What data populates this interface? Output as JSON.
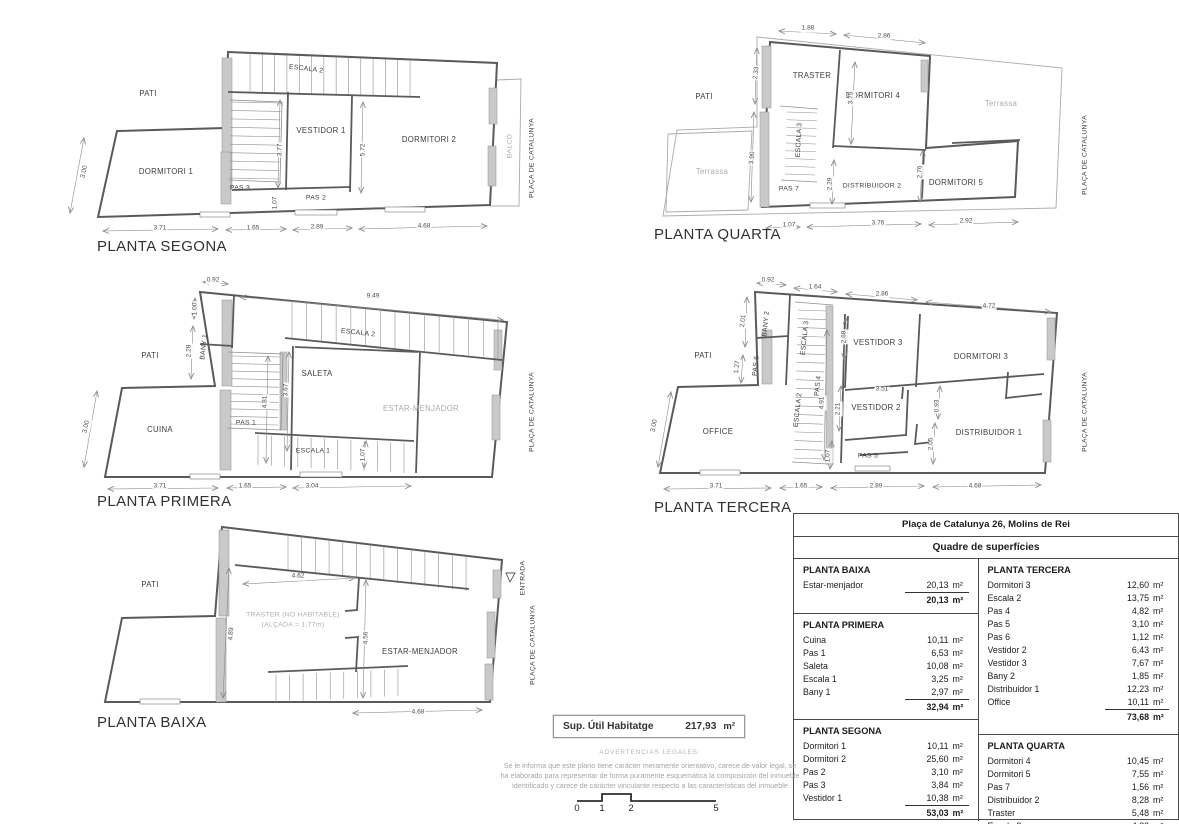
{
  "colors": {
    "wall_fill": "#c9c9c9",
    "line": "#5a5a5a",
    "thin": "#ababab",
    "dim": "#8a8a8a",
    "muted_text": "#adadad"
  },
  "plans": [
    {
      "id": "segona",
      "title": "PLANTA SEGONA",
      "labels": [
        {
          "t": "PATI",
          "x": 148,
          "y": 94
        },
        {
          "t": "ESCALA 2",
          "x": 306,
          "y": 70,
          "r": 7,
          "c": "sm"
        },
        {
          "t": "VESTIDOR 1",
          "x": 321,
          "y": 131
        },
        {
          "t": "DORMITORI 2",
          "x": 429,
          "y": 140
        },
        {
          "t": "DORMITORI 1",
          "x": 166,
          "y": 172
        },
        {
          "t": "PAS 3",
          "x": 240,
          "y": 189,
          "c": "sm"
        },
        {
          "t": "PAS 2",
          "x": 316,
          "y": 199,
          "c": "sm"
        },
        {
          "t": "BALCÓ",
          "x": 511,
          "y": 146,
          "r": -90,
          "c": "sm gy"
        },
        {
          "t": "PLAÇA DE CATALUNYA",
          "x": 533,
          "y": 158,
          "r": -90,
          "c": "sm"
        }
      ],
      "dims": [
        {
          "t": "3.00",
          "x": 85,
          "y": 172,
          "r": -78
        },
        {
          "t": "3.77",
          "x": 281,
          "y": 150,
          "r": -90
        },
        {
          "t": "5.72",
          "x": 364,
          "y": 150,
          "r": -90
        },
        {
          "t": "1.07",
          "x": 276,
          "y": 203,
          "r": -90
        },
        {
          "t": "3.71",
          "x": 160,
          "y": 229
        },
        {
          "t": "1.65",
          "x": 253,
          "y": 229
        },
        {
          "t": "2.89",
          "x": 317,
          "y": 228
        },
        {
          "t": "4.68",
          "x": 424,
          "y": 227
        }
      ]
    },
    {
      "id": "quarta",
      "title": "PLANTA QUARTA",
      "labels": [
        {
          "t": "PATI",
          "x": 704,
          "y": 97
        },
        {
          "t": "Terrassa",
          "x": 712,
          "y": 172,
          "c": "gy"
        },
        {
          "t": "TRASTER",
          "x": 812,
          "y": 76
        },
        {
          "t": "DORMITORI 4",
          "x": 873,
          "y": 96
        },
        {
          "t": "Terrassa",
          "x": 1001,
          "y": 104,
          "c": "gy"
        },
        {
          "t": "ESCALA 3",
          "x": 800,
          "y": 140,
          "r": -87,
          "c": "sm"
        },
        {
          "t": "PAS 7",
          "x": 789,
          "y": 190,
          "c": "sm"
        },
        {
          "t": "DISTRIBUIDOR 2",
          "x": 872,
          "y": 187,
          "c": "sm"
        },
        {
          "t": "DORMITORI 5",
          "x": 956,
          "y": 183
        },
        {
          "t": "PLAÇA DE CATALUNYA",
          "x": 1086,
          "y": 155,
          "r": -90,
          "c": "sm"
        }
      ],
      "dims": [
        {
          "t": "1.88",
          "x": 808,
          "y": 29
        },
        {
          "t": "2.86",
          "x": 884,
          "y": 37
        },
        {
          "t": "2.33",
          "x": 757,
          "y": 73,
          "r": -84
        },
        {
          "t": "3.90",
          "x": 753,
          "y": 158,
          "r": -84
        },
        {
          "t": "3.75",
          "x": 852,
          "y": 98,
          "r": -90
        },
        {
          "t": "2.29",
          "x": 831,
          "y": 184,
          "r": -90
        },
        {
          "t": "2.76",
          "x": 921,
          "y": 172,
          "r": -90
        },
        {
          "t": "1.07",
          "x": 789,
          "y": 226
        },
        {
          "t": "3.76",
          "x": 878,
          "y": 224
        },
        {
          "t": "2.92",
          "x": 966,
          "y": 222
        }
      ]
    },
    {
      "id": "primera",
      "title": "PLANTA PRIMERA",
      "labels": [
        {
          "t": "PATI",
          "x": 150,
          "y": 356
        },
        {
          "t": "BANY 1",
          "x": 205,
          "y": 347,
          "r": -84,
          "c": "sm"
        },
        {
          "t": "ESCALA 2",
          "x": 358,
          "y": 334,
          "r": 6,
          "c": "sm"
        },
        {
          "t": "SALETA",
          "x": 317,
          "y": 374
        },
        {
          "t": "ESTAR-MENJADOR",
          "x": 421,
          "y": 409,
          "c": "gy"
        },
        {
          "t": "CUINA",
          "x": 160,
          "y": 430
        },
        {
          "t": "PAS 1",
          "x": 246,
          "y": 424,
          "c": "sm"
        },
        {
          "t": "ESCALA 1",
          "x": 313,
          "y": 452,
          "c": "sm"
        },
        {
          "t": "PLAÇA DE CATALUNYA",
          "x": 533,
          "y": 412,
          "r": -90,
          "c": "sm"
        }
      ],
      "dims": [
        {
          "t": "0.92",
          "x": 213,
          "y": 281
        },
        {
          "t": "9.49",
          "x": 373,
          "y": 297
        },
        {
          "t": "1.00",
          "x": 196,
          "y": 309,
          "r": -90
        },
        {
          "t": "2.28",
          "x": 190,
          "y": 351,
          "r": -90
        },
        {
          "t": "3.00",
          "x": 87,
          "y": 427,
          "r": -78
        },
        {
          "t": "4.81",
          "x": 266,
          "y": 402,
          "r": -90
        },
        {
          "t": "3.67",
          "x": 287,
          "y": 390,
          "r": -90
        },
        {
          "t": "1.07",
          "x": 364,
          "y": 455,
          "r": -90
        },
        {
          "t": "3.71",
          "x": 160,
          "y": 487
        },
        {
          "t": "1.65",
          "x": 245,
          "y": 487
        },
        {
          "t": "3.04",
          "x": 312,
          "y": 487
        }
      ]
    },
    {
      "id": "tercera",
      "title": "PLANTA TERCERA",
      "labels": [
        {
          "t": "PATI",
          "x": 703,
          "y": 356
        },
        {
          "t": "BANY 2",
          "x": 767,
          "y": 324,
          "r": -84,
          "c": "sm"
        },
        {
          "t": "PAS 6",
          "x": 757,
          "y": 366,
          "r": -84,
          "c": "sm"
        },
        {
          "t": "ESCALA 3",
          "x": 806,
          "y": 338,
          "r": -84,
          "c": "sm"
        },
        {
          "t": "ESCALA 2",
          "x": 799,
          "y": 410,
          "r": -84,
          "c": "sm"
        },
        {
          "t": "PAS 4",
          "x": 819,
          "y": 386,
          "r": -84,
          "c": "sm"
        },
        {
          "t": "VESTIDOR 3",
          "x": 878,
          "y": 343
        },
        {
          "t": "DORMITORI 3",
          "x": 981,
          "y": 357
        },
        {
          "t": "VESTIDOR 2",
          "x": 876,
          "y": 408
        },
        {
          "t": "DISTRIBUIDOR 1",
          "x": 989,
          "y": 433
        },
        {
          "t": "OFFICE",
          "x": 718,
          "y": 432
        },
        {
          "t": "PAS 5",
          "x": 868,
          "y": 457,
          "c": "sm"
        },
        {
          "t": "PLAÇA DE CATALUNYA",
          "x": 1086,
          "y": 412,
          "r": -90,
          "c": "sm"
        }
      ],
      "dims": [
        {
          "t": "0.92",
          "x": 768,
          "y": 281
        },
        {
          "t": "1.64",
          "x": 815,
          "y": 288
        },
        {
          "t": "2.86",
          "x": 882,
          "y": 295
        },
        {
          "t": "4.72",
          "x": 989,
          "y": 307
        },
        {
          "t": "2.01",
          "x": 744,
          "y": 321,
          "r": -84
        },
        {
          "t": "1.27",
          "x": 738,
          "y": 367,
          "r": -84
        },
        {
          "t": "3.00",
          "x": 655,
          "y": 426,
          "r": -78
        },
        {
          "t": "2.68",
          "x": 845,
          "y": 337,
          "r": -90
        },
        {
          "t": "4.91",
          "x": 823,
          "y": 403,
          "r": -90
        },
        {
          "t": "2.21",
          "x": 839,
          "y": 409,
          "r": -90
        },
        {
          "t": "3.51",
          "x": 882,
          "y": 390,
          "c": "sm"
        },
        {
          "t": "0.93",
          "x": 938,
          "y": 406,
          "r": -90
        },
        {
          "t": "2.05",
          "x": 932,
          "y": 444,
          "r": -90
        },
        {
          "t": "1.07",
          "x": 829,
          "y": 456,
          "r": -90
        },
        {
          "t": "3.71",
          "x": 716,
          "y": 487
        },
        {
          "t": "1.65",
          "x": 801,
          "y": 487
        },
        {
          "t": "2.89",
          "x": 876,
          "y": 487
        },
        {
          "t": "4.68",
          "x": 975,
          "y": 487
        }
      ]
    },
    {
      "id": "baixa",
      "title": "PLANTA BAIXA",
      "labels": [
        {
          "t": "PATI",
          "x": 150,
          "y": 585
        },
        {
          "t": "TRASTER (NO HABITABLE)",
          "x": 293,
          "y": 616,
          "c": "sm gy"
        },
        {
          "t": "(ALÇADA = 1,77m)",
          "x": 293,
          "y": 626,
          "c": "sm gy"
        },
        {
          "t": "ESTAR-MENJADOR",
          "x": 420,
          "y": 652
        },
        {
          "t": "ENTRADA",
          "x": 524,
          "y": 578,
          "r": -90,
          "c": "sm"
        },
        {
          "t": "PLAÇA DE CATALUNYA",
          "x": 534,
          "y": 645,
          "r": -90,
          "c": "sm"
        }
      ],
      "dims": [
        {
          "t": "4.62",
          "x": 298,
          "y": 577
        },
        {
          "t": "4.89",
          "x": 232,
          "y": 634,
          "r": -86
        },
        {
          "t": "4.56",
          "x": 367,
          "y": 638,
          "r": -90
        },
        {
          "t": "4.68",
          "x": 418,
          "y": 713
        }
      ]
    }
  ],
  "table": {
    "title": "Plaça de Catalunya 26, Molins de Rei",
    "subtitle": "Quadre de superfícies",
    "unit": "m²",
    "columns": [
      {
        "sections": [
          {
            "name": "PLANTA BAIXA",
            "rows": [
              [
                "Estar-menjador",
                "20,13"
              ]
            ],
            "total": "20,13"
          },
          {
            "name": "PLANTA PRIMERA",
            "rows": [
              [
                "Cuina",
                "10,11"
              ],
              [
                "Pas 1",
                "6,53"
              ],
              [
                "Saleta",
                "10,08"
              ],
              [
                "Escala 1",
                "3,25"
              ],
              [
                "Bany 1",
                "2,97"
              ]
            ],
            "total": "32,94"
          },
          {
            "name": "PLANTA SEGONA",
            "rows": [
              [
                "Dormitori 1",
                "10,11"
              ],
              [
                "Dormitori 2",
                "25,60"
              ],
              [
                "Pas 2",
                "3,10"
              ],
              [
                "Pas 3",
                "3,84"
              ],
              [
                "Vestidor 1",
                "10,38"
              ]
            ],
            "total": "53,03"
          }
        ]
      },
      {
        "sections": [
          {
            "name": "PLANTA TERCERA",
            "rows": [
              [
                "Dormitori 3",
                "12,60"
              ],
              [
                "Escala 2",
                "13,75"
              ],
              [
                "Pas 4",
                "4,82"
              ],
              [
                "Pas 5",
                "3,10"
              ],
              [
                "Pas 6",
                "1,12"
              ],
              [
                "Vestidor 2",
                "6,43"
              ],
              [
                "Vestidor 3",
                "7,67"
              ],
              [
                "Bany 2",
                "1,85"
              ],
              [
                "Distribuidor 1",
                "12,23"
              ],
              [
                "Office",
                "10,11"
              ]
            ],
            "total": "73,68"
          },
          {
            "name": "PLANTA QUARTA",
            "rows": [
              [
                "Dormitori 4",
                "10,45"
              ],
              [
                "Dormitori 5",
                "7,55"
              ],
              [
                "Pas 7",
                "1,56"
              ],
              [
                "Distribuidor 2",
                "8,28"
              ],
              [
                "Traster",
                "5,48"
              ],
              [
                "Escala 3",
                "4,83"
              ]
            ],
            "total": "38,15"
          }
        ]
      }
    ]
  },
  "summary": {
    "label": "Sup. Útil Habitatge",
    "value": "217,93",
    "unit": "m²"
  },
  "legal": {
    "heading": "ADVERTENCIAS LEGALES:",
    "lines": [
      "Se le informa que este plano tiene carácter meramente orientativo, carece de valor legal, se",
      "ha elaborado para representar de forma puramente esquemática la composición del inmueble",
      "identificado y carece de carácter vinculante respecto a las características del inmueble"
    ]
  },
  "scalebar": {
    "ticks": [
      "0",
      "1",
      "2",
      "5"
    ]
  }
}
